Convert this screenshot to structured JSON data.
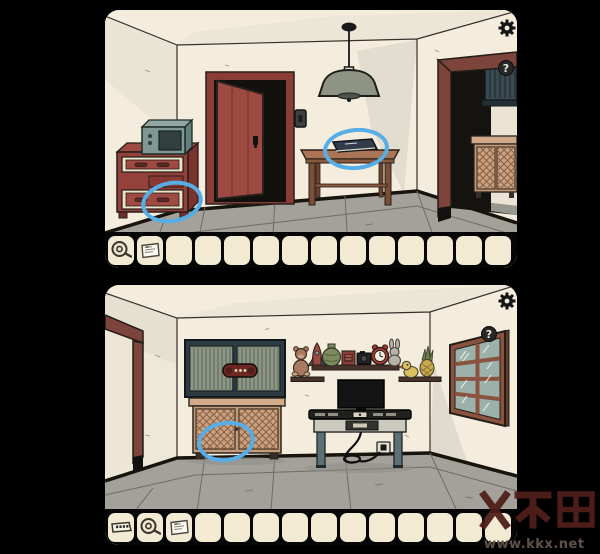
{
  "ui": {
    "settings_icon": "gear",
    "help_glyph": "?"
  },
  "watermark": {
    "url": "www.kkx.net"
  },
  "scenes": {
    "top": {
      "hint_circles": [
        "dresser-bottom-drawer",
        "book-on-table"
      ],
      "inventory": {
        "slot_count": 14,
        "items": [
          "tape-roll",
          "note-paper"
        ]
      }
    },
    "bottom": {
      "hint_circles": [
        "lattice-cabinet-left-door"
      ],
      "inventory": {
        "slot_count": 14,
        "items": [
          "code-strip",
          "tape-roll",
          "note-paper"
        ]
      }
    }
  },
  "colors": {
    "background": "#000000",
    "wall": "#f4ecdc",
    "floor": "#a3a19a",
    "hint_circle": "#57aee6",
    "slot": "#f2ead3",
    "door_red": "#9c4a42",
    "dresser_red": "#93413a",
    "watermark_red": "#4f1f1a"
  }
}
